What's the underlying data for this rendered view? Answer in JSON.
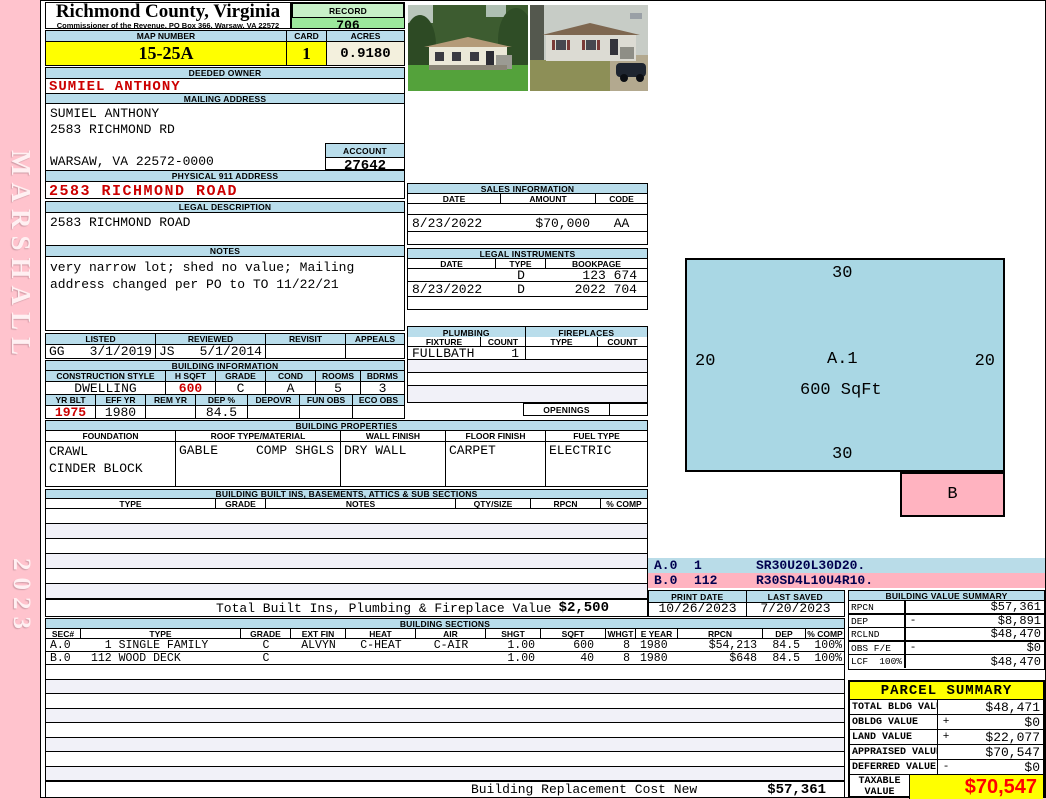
{
  "sidebar": {
    "vendor": "MARSHALL",
    "year": "2023"
  },
  "header": {
    "county": "Richmond County, Virginia",
    "commissioner": "Commissioner of the Revenue, PO Box 366, Warsaw, VA 22572",
    "record_label": "RECORD",
    "record": "706",
    "map_label": "MAP NUMBER",
    "map_number": "15-25A",
    "card_label": "CARD",
    "card": "1",
    "acres_label": "ACRES",
    "acres": "0.9180"
  },
  "owner": {
    "deeded_label": "DEEDED OWNER",
    "name": "SUMIEL ANTHONY",
    "mailing_label": "MAILING ADDRESS",
    "mail1": "SUMIEL ANTHONY",
    "mail2": "2583 RICHMOND RD",
    "mail3": "",
    "mail4": "WARSAW, VA 22572-0000",
    "account_label": "ACCOUNT",
    "account": "27642",
    "physical_label": "PHYSICAL 911 ADDRESS",
    "physical": "2583 RICHMOND ROAD",
    "legal_label": "LEGAL DESCRIPTION",
    "legal": "2583 RICHMOND ROAD",
    "notes_label": "NOTES",
    "notes": "very narrow lot; shed no value; Mailing address changed per PO to TO 11/22/21"
  },
  "review": {
    "listed_label": "LISTED",
    "reviewed_label": "REVIEWED",
    "revisit_label": "REVISIT",
    "appeals_label": "APPEALS",
    "listed_by": "GG",
    "listed_date": "3/1/2019",
    "reviewed_by": "JS",
    "reviewed_date": "5/1/2014",
    "revisit": "",
    "appeals": ""
  },
  "building_information": {
    "title": "BUILDING INFORMATION",
    "h_style": "CONSTRUCTION STYLE",
    "h_sqft": "H SQFT",
    "h_grade": "GRADE",
    "h_cond": "COND",
    "h_rooms": "ROOMS",
    "h_bdrms": "BDRMS",
    "style": "DWELLING",
    "sqft": "600",
    "grade": "C",
    "cond": "A",
    "rooms": "5",
    "bdrms": "3",
    "h_yrblt": "YR BLT",
    "h_effyr": "EFF YR",
    "h_remyr": "REM YR",
    "h_dep": "DEP %",
    "h_depovr": "DEPOVR",
    "h_funobs": "FUN OBS",
    "h_ecoobs": "ECO OBS",
    "yrblt": "1975",
    "effyr": "1980",
    "remyr": "",
    "dep": "84.5",
    "depovr": "",
    "funobs": "",
    "ecoobs": ""
  },
  "sales": {
    "title": "SALES INFORMATION",
    "h_date": "DATE",
    "h_amount": "AMOUNT",
    "h_code": "CODE",
    "date": "8/23/2022",
    "amount": "$70,000",
    "code": "AA"
  },
  "legal_instruments": {
    "title": "LEGAL INSTRUMENTS",
    "h_date": "DATE",
    "h_type": "TYPE",
    "h_bookpage": "BOOKPAGE",
    "rows": [
      {
        "date": "",
        "type": "D",
        "bookpage": "123 674"
      },
      {
        "date": "8/23/2022",
        "type": "D",
        "bookpage": "2022 704"
      }
    ]
  },
  "plumbing": {
    "title": "PLUMBING",
    "h_fixture": "FIXTURE",
    "h_count": "COUNT",
    "fixture": "FULLBATH",
    "count": "1"
  },
  "fireplaces": {
    "title": "FIREPLACES",
    "h_type": "TYPE",
    "h_count": "COUNT",
    "openings_label": "OPENINGS"
  },
  "building_properties": {
    "title": "BUILDING PROPERTIES",
    "h_foundation": "FOUNDATION",
    "h_roof": "ROOF TYPE/MATERIAL",
    "h_wall": "WALL FINISH",
    "h_floor": "FLOOR FINISH",
    "h_fuel": "FUEL TYPE",
    "foundation1": "CRAWL",
    "foundation2": "CINDER BLOCK",
    "roof_type": "GABLE",
    "roof_material": "COMP SHGLS",
    "wall": "DRY WALL",
    "floor": "CARPET",
    "fuel": "ELECTRIC"
  },
  "built_ins": {
    "title": "BUILDING BUILT INS, BASEMENTS, ATTICS & SUB SECTIONS",
    "h_type": "TYPE",
    "h_grade": "GRADE",
    "h_notes": "NOTES",
    "h_qty": "QTY/SIZE",
    "h_rpcn": "RPCN",
    "h_comp": "% COMP",
    "total_label": "Total Built Ins, Plumbing & Fireplace Value",
    "total_value": "$2,500"
  },
  "sketch": {
    "top": "30",
    "left": "20",
    "right": "20",
    "bottom": "30",
    "a_label": "A.1",
    "a_sqft": "600 SqFt",
    "b_label": "B",
    "codes": [
      {
        "sec": "A.0",
        "num": "1",
        "path": "SR30U20L30D20."
      },
      {
        "sec": "B.0",
        "num": "112",
        "path": "R30SD4L10U4R10."
      }
    ]
  },
  "print_info": {
    "print_label": "PRINT DATE",
    "print_date": "10/26/2023",
    "saved_label": "LAST SAVED",
    "saved_date": "7/20/2023"
  },
  "building_value_summary": {
    "title": "BUILDING VALUE SUMMARY",
    "rows": [
      {
        "label": "RPCN",
        "sub": "",
        "op": "",
        "value": "$57,361"
      },
      {
        "label": "DEP",
        "sub": "",
        "op": "-",
        "value": "$8,891"
      },
      {
        "label": "RCLND",
        "sub": "",
        "op": "",
        "value": "$48,470"
      },
      {
        "label": "OBS F/E",
        "sub": "",
        "op": "-",
        "value": "$0"
      },
      {
        "label": "LCF",
        "sub": "100%",
        "op": "",
        "value": "$48,470"
      }
    ]
  },
  "building_sections": {
    "title": "BUILDING SECTIONS",
    "h_sec": "SEC#",
    "h_type": "TYPE",
    "h_grade": "GRADE",
    "h_extfin": "EXT FIN",
    "h_heat": "HEAT",
    "h_air": "AIR",
    "h_shgt": "SHGT",
    "h_sqft": "SQFT",
    "h_whgt": "WHGT",
    "h_eyear": "E YEAR",
    "h_rpcn": "RPCN",
    "h_dep": "DEP",
    "h_comp": "% COMP",
    "rows": [
      {
        "sec": "A.0",
        "type": "  1 SINGLE FAMILY",
        "grade": "C",
        "extfin": "ALVYN",
        "heat": "C-HEAT",
        "air": "C-AIR",
        "shgt": "1.00",
        "sqft": "600",
        "whgt": "8",
        "eyear": "1980",
        "rpcn": "$54,213",
        "dep": "84.5",
        "comp": "100%"
      },
      {
        "sec": "B.0",
        "type": "112 WOOD DECK",
        "grade": "C",
        "extfin": "",
        "heat": "",
        "air": "",
        "shgt": "1.00",
        "sqft": "40",
        "whgt": "8",
        "eyear": "1980",
        "rpcn": "$648",
        "dep": "84.5",
        "comp": "100%"
      }
    ]
  },
  "footer": {
    "label": "Building Replacement Cost New",
    "value": "$57,361"
  },
  "parcel_summary": {
    "title": "PARCEL SUMMARY",
    "rows": [
      {
        "label": "TOTAL BLDG VALUE",
        "op": "",
        "value": "$48,471"
      },
      {
        "label": "OBLDG VALUE",
        "op": "+",
        "value": "$0"
      },
      {
        "label": "LAND VALUE",
        "op": "+",
        "value": "$22,077"
      },
      {
        "label": "APPRAISED VALUE",
        "op": "",
        "value": "$70,547"
      },
      {
        "label": "DEFERRED VALUE",
        "op": "-",
        "value": "$0"
      }
    ],
    "taxable_label": "TAXABLE VALUE",
    "taxable_value": "$70,547"
  },
  "colors": {
    "header_blue": "#b9ddeb",
    "record_green": "#9ce89c",
    "map_yellow": "#ffff00",
    "sidebar_pink": "#ffc3cd",
    "sketch_blue": "#a9d7e4",
    "sketch_pink": "#ffb3c0",
    "red_text": "#cc0000",
    "taxable_red": "#ff0000"
  }
}
